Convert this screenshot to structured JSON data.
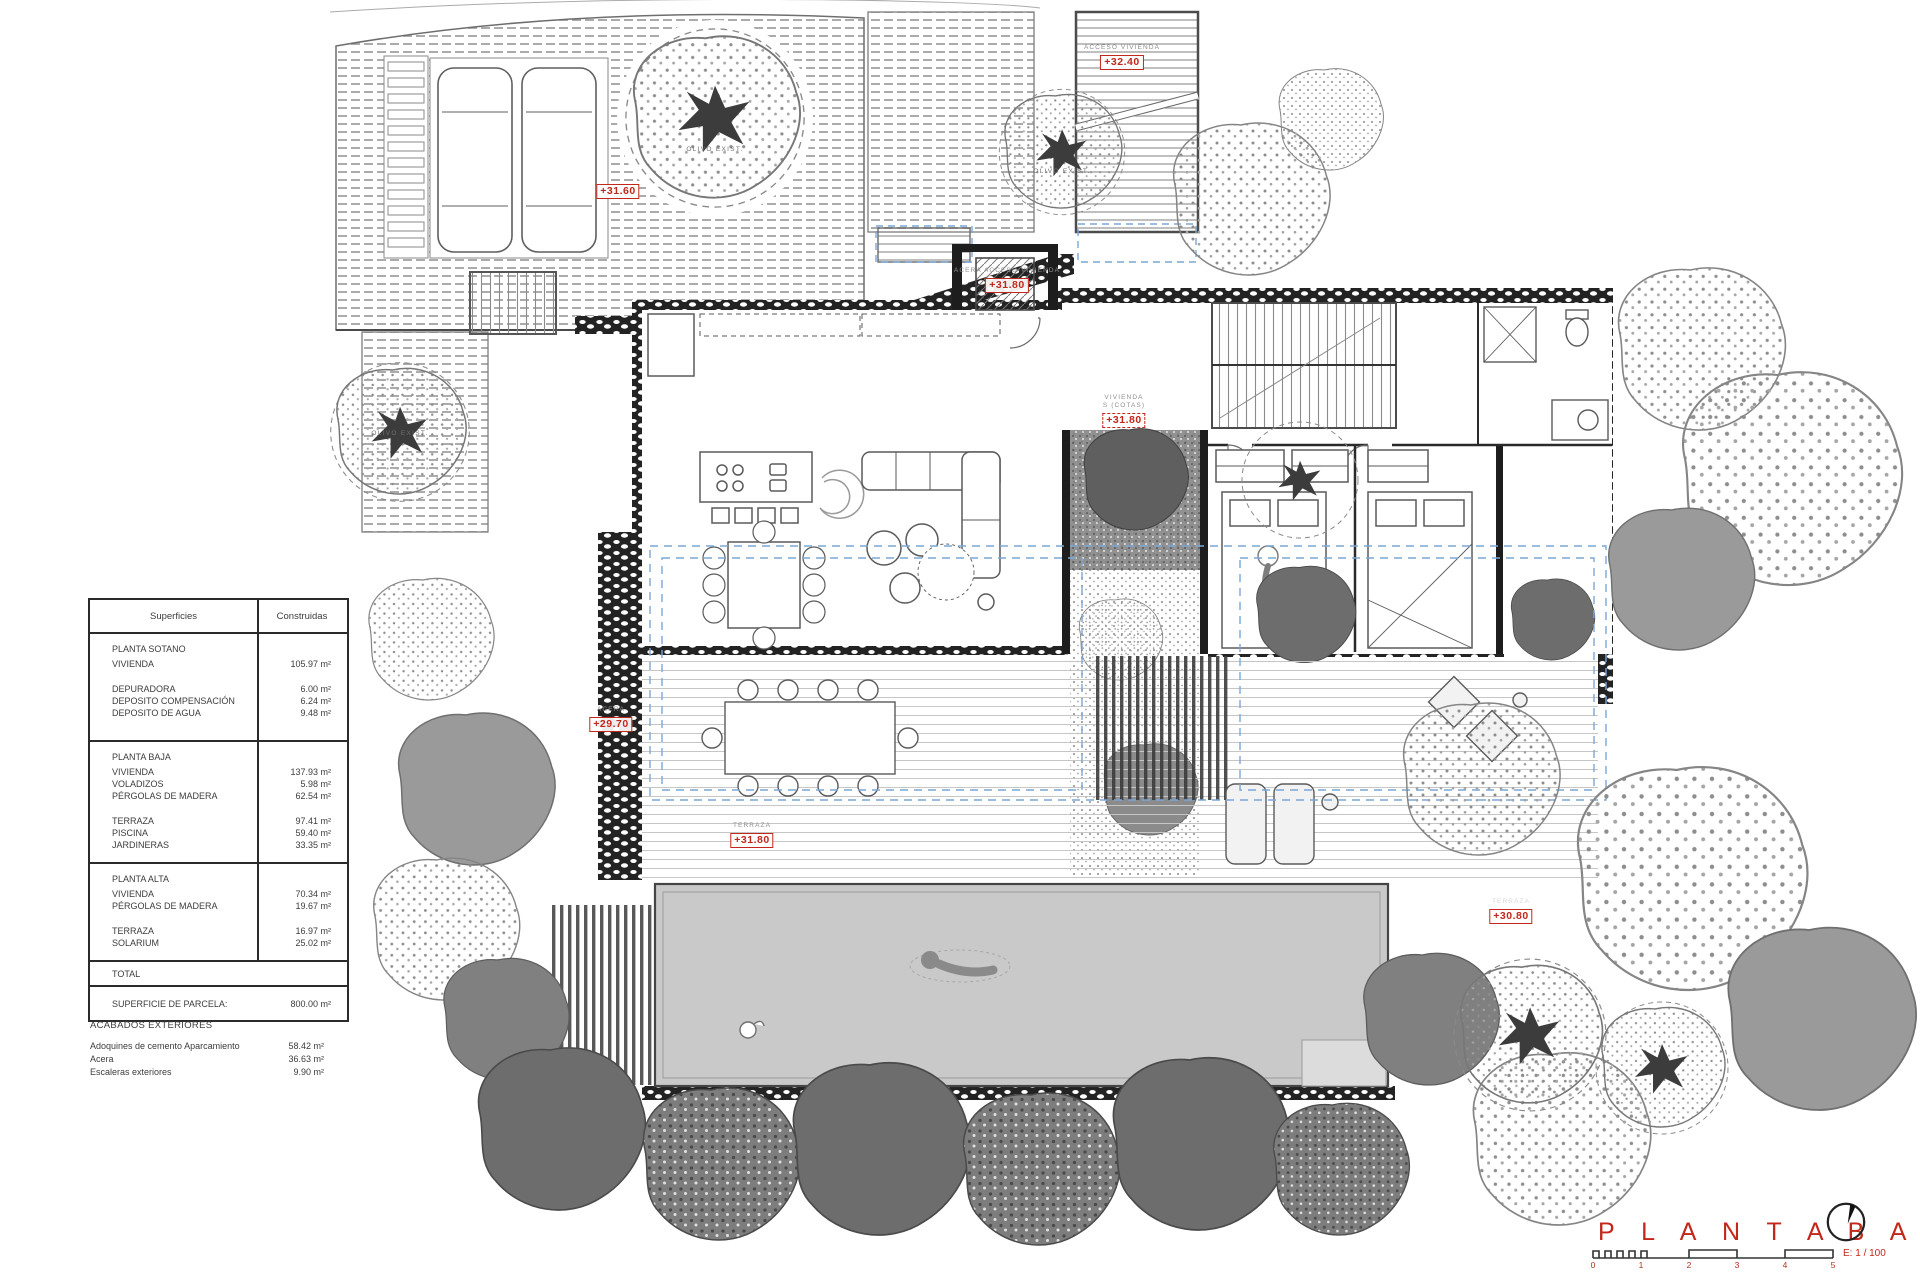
{
  "colors": {
    "accent_red": "#c3261a",
    "pergola_blue": "#7aa7d9"
  },
  "surfaces_table": {
    "col1_header": "Superficies",
    "col2_header": "Construidas",
    "sotano": {
      "title": "PLANTA SOTANO",
      "rows": [
        [
          "VIVIENDA",
          "105.97 m²"
        ],
        [
          "DEPURADORA",
          "6.00 m²"
        ],
        [
          "DEPOSITO COMPENSACIÓN",
          "6.24 m²"
        ],
        [
          "DEPOSITO DE AGUA",
          "9.48 m²"
        ]
      ]
    },
    "baja": {
      "title": "PLANTA BAJA",
      "rows": [
        [
          "VIVIENDA",
          "137.93 m²"
        ],
        [
          "VOLADIZOS",
          "5.98 m²"
        ],
        [
          "PÉRGOLAS DE MADERA",
          "62.54 m²"
        ],
        [
          "TERRAZA",
          "97.41 m²"
        ],
        [
          "PISCINA",
          "59.40 m²"
        ],
        [
          "JARDINERAS",
          "33.35 m²"
        ]
      ]
    },
    "alta": {
      "title": "PLANTA ALTA",
      "rows": [
        [
          "VIVIENDA",
          "70.34 m²"
        ],
        [
          "PÉRGOLAS DE MADERA",
          "19.67 m²"
        ],
        [
          "TERRAZA",
          "16.97 m²"
        ],
        [
          "SOLARIUM",
          "25.02 m²"
        ]
      ]
    },
    "total_label": "TOTAL",
    "parcela_label": "SUPERFICIE DE PARCELA:",
    "parcela_value": "800.00 m²"
  },
  "exterior_finishes": {
    "title": "ACABADOS EXTERIORES",
    "rows": [
      [
        "Adoquines de cemento Aparcamiento",
        "58.42 m²"
      ],
      [
        "Acera",
        "36.63 m²"
      ],
      [
        "Escaleras exteriores",
        "9.90 m²"
      ]
    ]
  },
  "plan_labels": {
    "garage_level": {
      "value": "+31.60"
    },
    "access": {
      "caption": "ACCESO VIVIENDA",
      "value": "+32.40"
    },
    "acera_access": {
      "caption": "ACERA  ACCESO  VIVIENDA",
      "value": "+31.80"
    },
    "vivienda": {
      "caption_line1": "VIVIENDA",
      "caption_line2": "S (COTAS)",
      "value": "+31.80"
    },
    "acera_oeste": {
      "caption": "ACERA",
      "value": "+29.70"
    },
    "terraza": {
      "caption": "TERRAZA",
      "value": "+31.80"
    },
    "terraza_este": {
      "caption": "TERRAZA",
      "value": "+30.80"
    },
    "olivo": "OLIVO EXIST."
  },
  "titleblock": {
    "title_word1": "P L A N T A",
    "title_word2": "B A J A",
    "scale_label": "E: 1 / 100",
    "ticks": [
      "0",
      "1",
      "2",
      "3",
      "4",
      "5"
    ]
  }
}
